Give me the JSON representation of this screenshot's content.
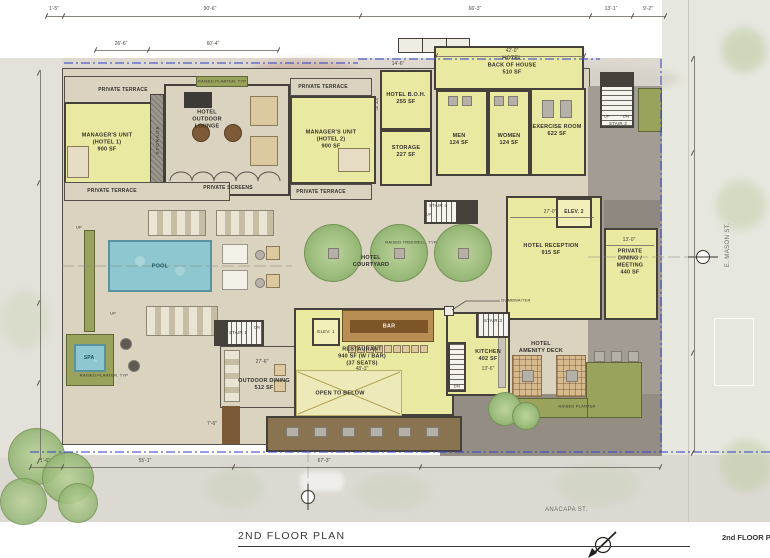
{
  "title": "2ND FLOOR PLAN",
  "corner_title": "2nd FLOOR PL",
  "streets": {
    "bottom": "ANACAPA ST.",
    "right": "E. MASON ST."
  },
  "rooms": {
    "private_terrace": "PRIVATE TERRACE",
    "managers_unit_1": "MANAGER'S UNIT\n(HOTEL 1)\n900 SF",
    "managers_unit_2": "MANAGER'S UNIT\n(HOTEL 2)\n900 SF",
    "storage_shaft": "STORAGE",
    "hotel_outdoor_lounge": "HOTEL\nOUTDOOR\nLOUNGE",
    "private_screens": "PRIVATE SCREENS",
    "raised_planter_typ": "RAISED PLANTER, TYP",
    "hotel_boh": "HOTEL B.O.H.\n255 SF",
    "storage": "STORAGE\n227 SF",
    "hotel_back_of_house": "HOTEL\nBACK OF HOUSE\n510 SF",
    "men": "MEN\n124 SF",
    "women": "WOMEN\n124 SF",
    "exercise_room": "EXERCISE ROOM\n622 SF",
    "stair_1": "STAIR 1",
    "stair_2": "STAIR 2",
    "stair_3": "STAIR 3",
    "stair_4": "STAIR 4",
    "elev_1": "ELEV. 1",
    "elev_2": "ELEV. 2",
    "hotel_reception": "HOTEL RECEPTION\n915 SF",
    "private_dining": "PRIVATE\nDINING /\nMEETING\n440 SF",
    "hotel_courtyard": "HOTEL\nCOURTYARD",
    "raised_treewell_typ": "RAISED TREEWELL, TYP",
    "pool": "POOL",
    "spa": "SPA",
    "bar": "BAR",
    "restaurant": "RESTAURANT\n940 SF (W / BAR)\n(37 SEATS)",
    "open_to_below": "OPEN TO BELOW",
    "kitchen": "KITCHEN\n402 SF",
    "dumbwaiter": "DUMBWAITER",
    "outdoor_dining": "OUTDOOR DINING\n512 SF",
    "hotel_amenity_deck": "HOTEL\nAMENITY DECK",
    "raised_planter": "RAISED PLANTER"
  },
  "markers": {
    "up": "UP",
    "dn": "DN"
  },
  "dims": {
    "top": [
      "1'-5\"",
      "90'-6\"",
      "66'-3\"",
      "13'-1\"",
      "9'-2\""
    ],
    "top2": [
      "26'-6\"",
      "60'-4\"",
      "42'-0\""
    ],
    "bottom": [
      "1'-6\"",
      "55'-1\"",
      "67'-3\""
    ],
    "inner": [
      "27'-0\"",
      "13'-0\"",
      "14'-6\"",
      "22'-3\"",
      "27'-6\"",
      "13'-6\"",
      "48'-3\"",
      "7'-6\""
    ]
  },
  "colors": {
    "room_fill": "#eae9a2",
    "wall": "#45413a",
    "pool": "#8ec7cf",
    "tree": "#9dbd7e",
    "planter": "#9aa35c",
    "deck": "#d9d3c0",
    "paving": "#a29c92",
    "property_line": "#3a46c8"
  }
}
